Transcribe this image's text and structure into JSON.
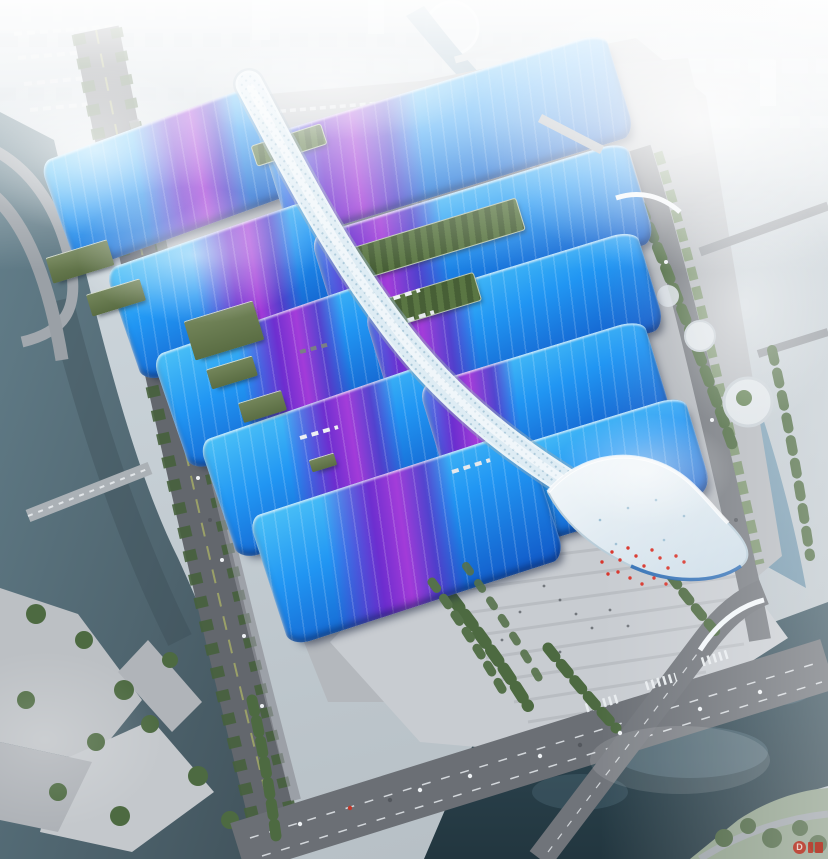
{
  "scene": {
    "type": "aerial architectural rendering",
    "subject": "Bird's-eye concept rendering of a riverside exhibition and convention center: paired exhibition halls with blue wave roofs crossed by purple ribbon bands, a white serpentine pedestrian canopy spine down the middle, a wavy white entrance canopy at the south end, service yards, tree-lined arterial roads, canals and a dark river bend, all fading into a hazy white city skyline",
    "halls": {
      "left_column": 5,
      "right_column": 5,
      "roof_garden_strips": 3
    },
    "landmarks": [
      "central-serpentine-canopy",
      "entrance-wave-canopy",
      "forecourt-plaza-with-red-festival-decor",
      "left-canal",
      "right-river",
      "dark-river-bend",
      "waterfront-terraced-park",
      "city-skyline-in-haze"
    ]
  },
  "watermark": {
    "logo_text": "D",
    "color": "#c23a2c"
  },
  "palette": {
    "roof_blue_light": "#4cc2f7",
    "roof_blue_deep": "#1157c6",
    "roof_purple": "#702acd",
    "roof_magenta": "#a838d8",
    "spine_white": "#e9f3f8",
    "ground_gray": "#b4b8bd",
    "road_gray": "#63676d",
    "tree_green": "#46603c",
    "canal_teal": "#5a7380",
    "river_blue": "#8fb0c4",
    "dark_water": "#2b4150",
    "haze_white": "#f2f6f8"
  }
}
